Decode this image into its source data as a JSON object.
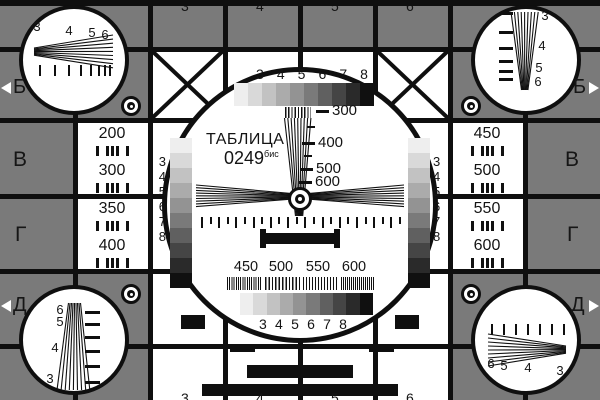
{
  "card": {
    "title": "ТАБЛИЦА",
    "number": "0249",
    "suffix": "бис"
  },
  "colors": {
    "bg_gray": "#7a7a7a",
    "line_black": "#0f0f0f",
    "white": "#ffffff"
  },
  "grayscale": {
    "labels": [
      "3",
      "4",
      "5",
      "6",
      "7",
      "8"
    ],
    "steps": [
      "#eeeeee",
      "#d9d9d9",
      "#c2c2c2",
      "#ababab",
      "#939393",
      "#7a7a7a",
      "#606060",
      "#454545",
      "#2a2a2a",
      "#101010"
    ]
  },
  "wedge_scale": [
    "300",
    "400",
    "500",
    "600"
  ],
  "freq_scale": [
    "450",
    "500",
    "550",
    "600"
  ],
  "side_letters": {
    "b": "Б",
    "v": "В",
    "g": "Г",
    "d": "Д"
  },
  "left_panel": {
    "r3a": "200",
    "r3b": "300",
    "r4a": "350",
    "r4b": "400"
  },
  "right_panel": {
    "r3a": "450",
    "r3b": "500",
    "r4a": "550",
    "r4b": "600"
  },
  "corner_labels": {
    "top_left": [
      "3",
      "4",
      "5",
      "6"
    ],
    "top_right": [
      "3",
      "4",
      "5",
      "6"
    ],
    "bottom_left": [
      "6",
      "5",
      "4",
      "3"
    ],
    "bottom_right": [
      "6",
      "5",
      "4",
      "3"
    ]
  },
  "crop_digits_top": [
    "3",
    "4",
    "5",
    "6"
  ],
  "crop_digits_bottom": [
    "3",
    "4",
    "5",
    "6"
  ]
}
